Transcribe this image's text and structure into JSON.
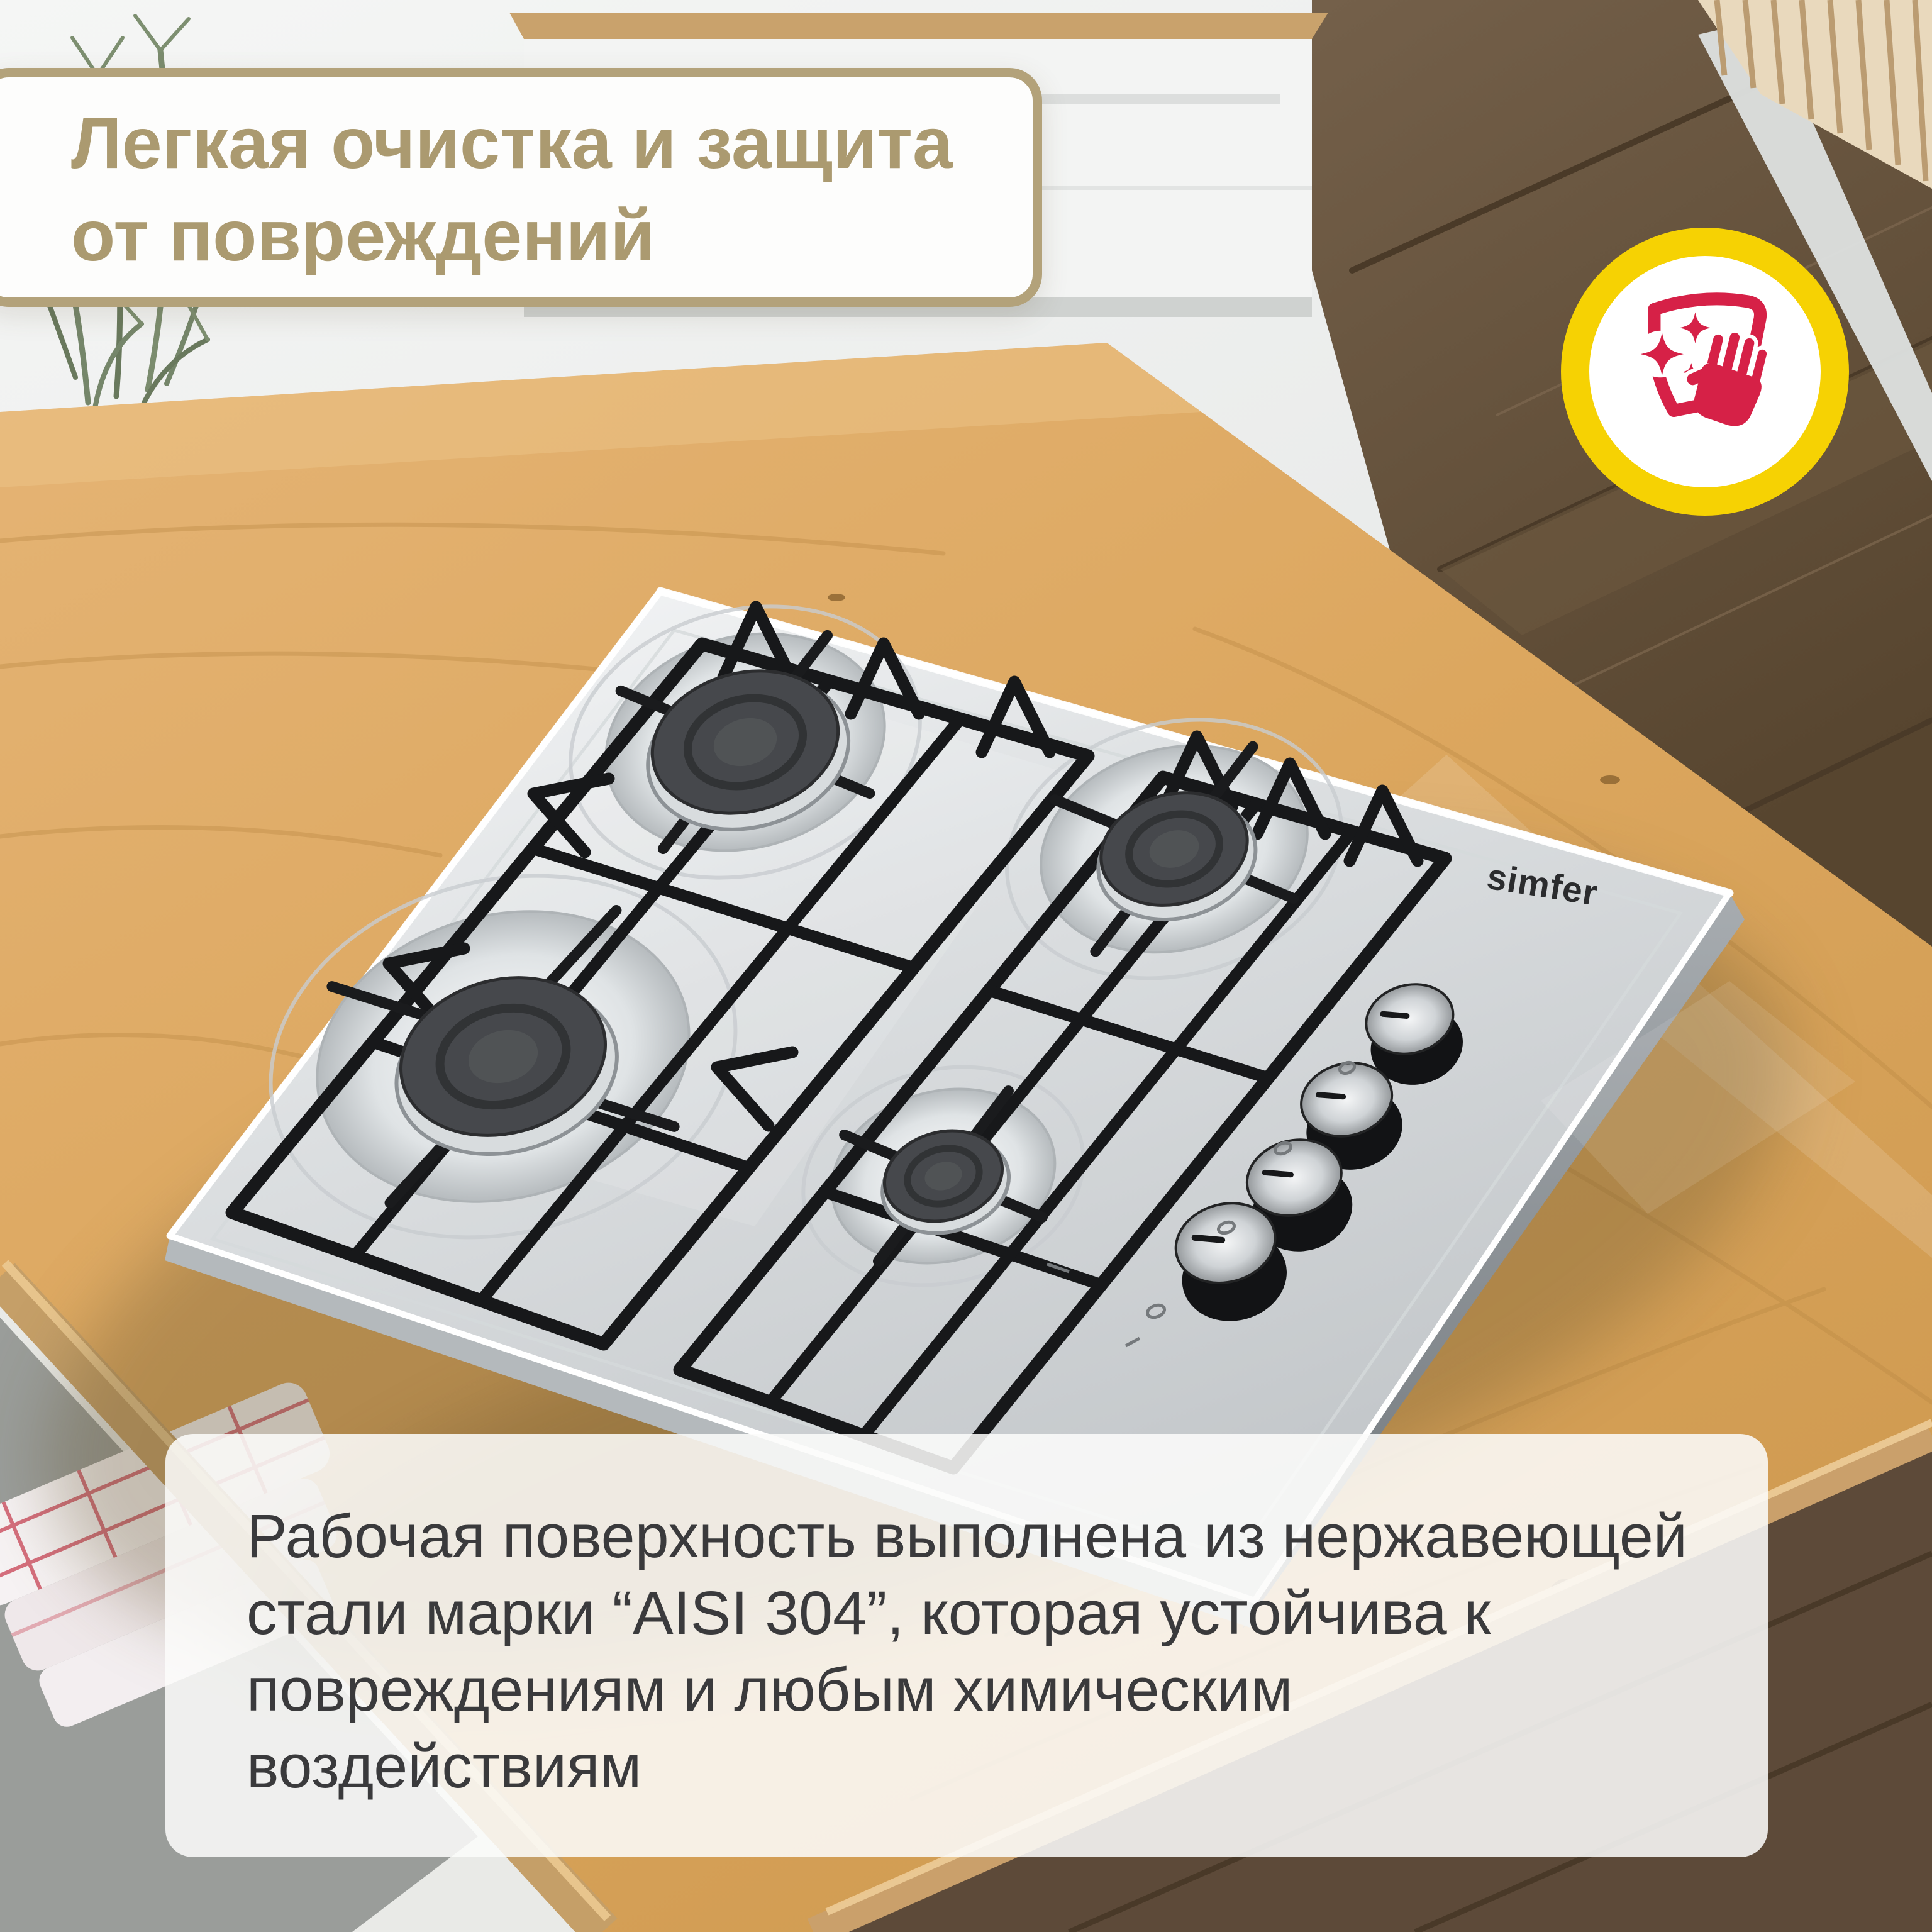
{
  "title_card": {
    "line1": "Легкая очистка и защита",
    "line2": "от повреждений"
  },
  "badge": {
    "icon": "clean-wipe-icon"
  },
  "hob": {
    "brand": "simfer",
    "burner_count": 4,
    "knob_count": 4
  },
  "description_card": {
    "lines": [
      "Рабочая поверхность выполнена из нержавеющей",
      "стали марки “AISI 304”, которая устойчива к",
      "повреждениям и любым химическим",
      "воздействиям"
    ]
  },
  "colors": {
    "title_text": "#ab9a70",
    "card_border": "#b3a27a",
    "badge_ring": "#f6d203",
    "badge_glyph": "#d62147",
    "description_text": "#3a3a3c",
    "countertop": "#d9a75f",
    "floor": "#69563f",
    "steel": "#d6dadc"
  }
}
